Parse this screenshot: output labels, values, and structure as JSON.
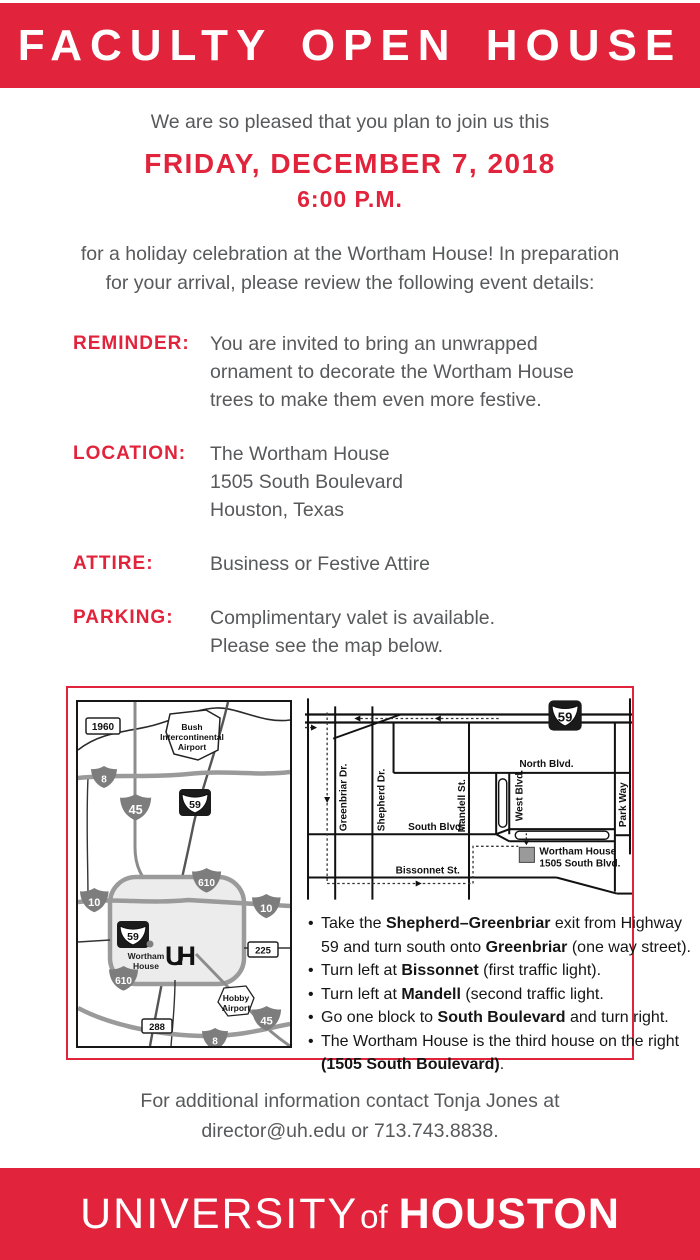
{
  "colors": {
    "brand_red": "#E1233B",
    "text_gray": "#58595B",
    "ink": "#151515"
  },
  "header": {
    "title": "FACULTY OPEN HOUSE"
  },
  "intro": {
    "greeting": "We are so pleased that you plan to join us this",
    "date": "FRIDAY, DECEMBER 7, 2018",
    "time": "6:00 P.M."
  },
  "lead": {
    "line1": "for a holiday celebration at the Wortham House! In preparation",
    "line2": "for your arrival, please review the following event details:"
  },
  "details": {
    "reminder": {
      "label": "REMINDER:",
      "lines": [
        "You are invited to bring an unwrapped",
        "ornament to decorate the Wortham House",
        "trees to make them even more festive."
      ]
    },
    "location": {
      "label": "LOCATION:",
      "lines": [
        "The Wortham House",
        "1505 South Boulevard",
        "Houston, Texas"
      ]
    },
    "attire": {
      "label": "ATTIRE:",
      "lines": [
        "Business or Festive Attire"
      ]
    },
    "parking": {
      "label": "PARKING:",
      "lines": [
        "Complimentary valet is available.",
        "Please see the map below."
      ]
    }
  },
  "map": {
    "left": {
      "shield_1960": "1960",
      "shield_beltway8": "8",
      "shield_45": "45",
      "shield_59": "59",
      "shield_610": "610",
      "shield_10": "10",
      "shield_225": "225",
      "shield_288": "288",
      "bush_airport": [
        "Bush",
        "Intercontinental",
        "Airport"
      ],
      "hobby_airport": [
        "Hobby",
        "Airport"
      ],
      "wortham": [
        "Wortham",
        "House"
      ],
      "uh_logo": "UH"
    },
    "right": {
      "hwy_59": "59",
      "greenbriar": "Greenbriar Dr.",
      "shepherd": "Shepherd Dr.",
      "mandell": "Mandell St.",
      "west": "West Blvd.",
      "parkway": "Park Way",
      "north": "North Blvd.",
      "south": "South Blvd.",
      "bissonnet": "Bissonnet St.",
      "house_line1": "Wortham House",
      "house_line2": "1505 South Blvd."
    },
    "directions": [
      {
        "segments": [
          {
            "t": "Take the "
          },
          {
            "t": "Shepherd–Greenbriar",
            "b": true
          },
          {
            "t": " exit from Highway"
          }
        ]
      },
      {
        "segments": [
          {
            "t": "59 and turn south onto "
          },
          {
            "t": "Greenbriar",
            "b": true
          },
          {
            "t": " (one way street)."
          }
        ]
      },
      {
        "segments": [
          {
            "t": "Turn left at "
          },
          {
            "t": "Bissonnet",
            "b": true
          },
          {
            "t": " (first traffic light)."
          }
        ]
      },
      {
        "segments": [
          {
            "t": "Turn left at "
          },
          {
            "t": "Mandell",
            "b": true
          },
          {
            "t": " (second traffic light."
          }
        ]
      },
      {
        "segments": [
          {
            "t": "Go one block to "
          },
          {
            "t": "South Boulevard",
            "b": true
          },
          {
            "t": " and turn right."
          }
        ]
      },
      {
        "segments": [
          {
            "t": "The Wortham House is the third house on the right"
          }
        ]
      },
      {
        "segments": [
          {
            "t": "(1505 South Boulevard)",
            "b": true
          },
          {
            "t": "."
          }
        ]
      }
    ]
  },
  "contact": {
    "line1": "For additional information contact Tonja Jones at",
    "line2": "director@uh.edu or 713.743.8838."
  },
  "footer": {
    "university": "UNIVERSITY",
    "of": "of",
    "houston": "HOUSTON"
  }
}
